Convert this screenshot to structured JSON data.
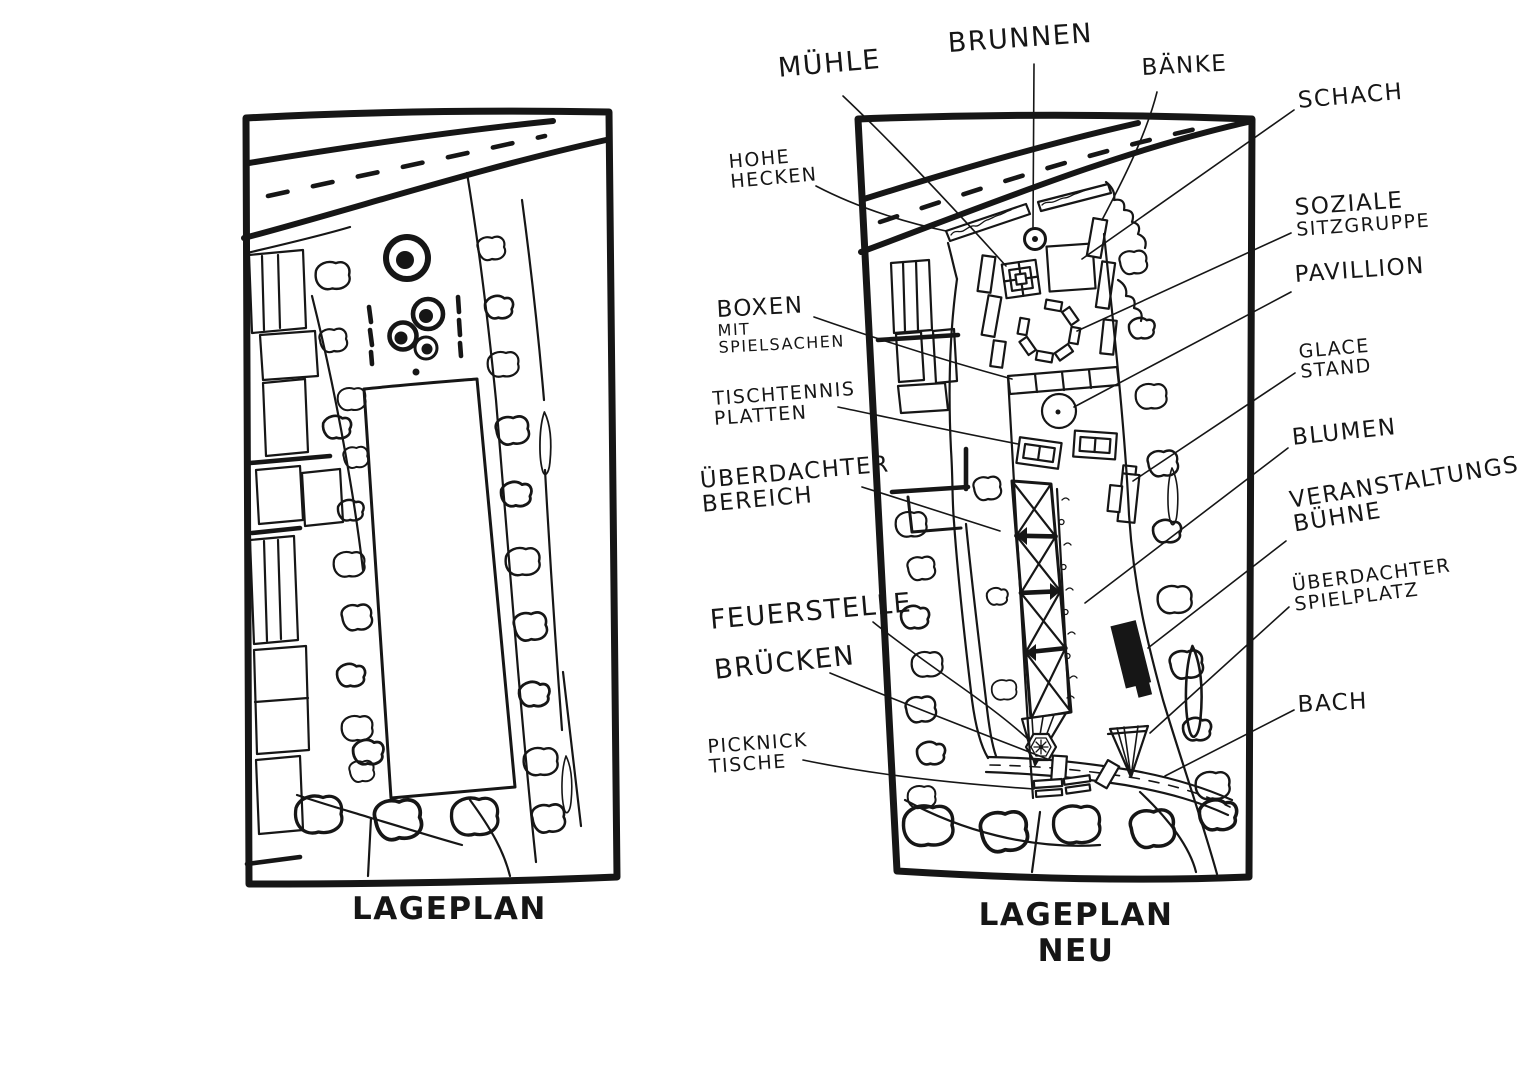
{
  "colors": {
    "ink": "#161616",
    "paper": "#ffffff"
  },
  "left_plan": {
    "caption": "LAGEPLAN"
  },
  "right_plan": {
    "caption": {
      "line1": "LAGEPLAN",
      "line2": "NEU"
    }
  },
  "labels": {
    "muehle": {
      "lines": [
        "MÜHLE"
      ]
    },
    "brunnen": {
      "lines": [
        "BRUNNEN"
      ]
    },
    "baenke": {
      "lines": [
        "BÄNKE"
      ]
    },
    "schach": {
      "lines": [
        "SCHACH"
      ]
    },
    "hohe_hecken": {
      "lines": [
        "HOHE",
        "HECKEN"
      ]
    },
    "soziale_sitzgruppe": {
      "lines": [
        "SOZIALE",
        "SITZGRUPPE"
      ]
    },
    "pavillion": {
      "lines": [
        "PAVILLION"
      ]
    },
    "boxen_mit_spielsachen": {
      "lines": [
        "BOXEN",
        "MIT",
        "SPIELSACHEN"
      ]
    },
    "glace_stand": {
      "lines": [
        "GLACE",
        "STAND"
      ]
    },
    "tischtennis_platten": {
      "lines": [
        "TISCHTENNIS",
        "PLATTEN"
      ]
    },
    "blumen": {
      "lines": [
        "BLUMEN"
      ]
    },
    "ueberdachter_bereich": {
      "lines": [
        "ÜBERDACHTER",
        "BEREICH"
      ]
    },
    "veranstaltungs_buehne": {
      "lines": [
        "VERANSTALTUNGS",
        "BÜHNE"
      ]
    },
    "ueberdachter_spielplatz": {
      "lines": [
        "ÜBERDACHTER",
        "SPIELPLATZ"
      ]
    },
    "feuerstelle": {
      "lines": [
        "FEUERSTELLE"
      ]
    },
    "bruecken": {
      "lines": [
        "BRÜCKEN"
      ]
    },
    "bach": {
      "lines": [
        "BACH"
      ]
    },
    "picknick_tische": {
      "lines": [
        "PICKNICK",
        "TISCHE"
      ]
    }
  }
}
